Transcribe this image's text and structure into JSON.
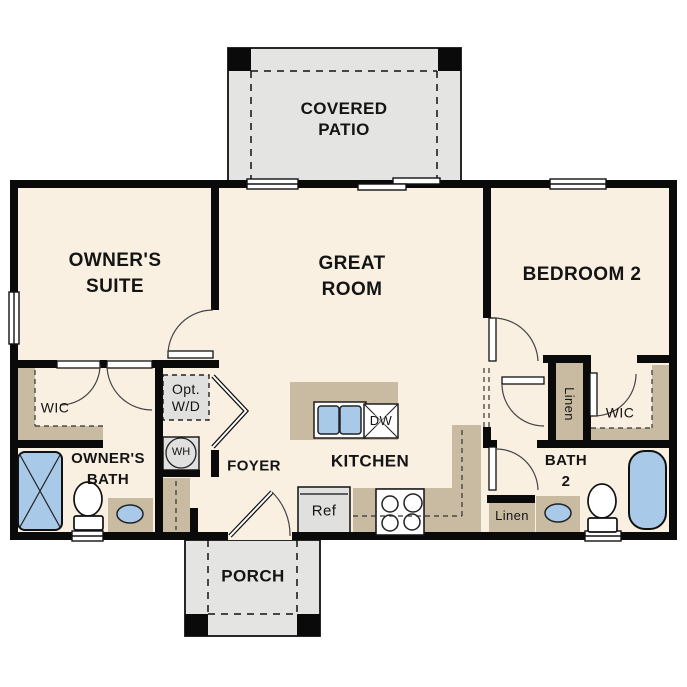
{
  "floorplan": {
    "rooms": {
      "covered_patio": {
        "line1": "COVERED",
        "line2": "PATIO"
      },
      "owners_suite": {
        "line1": "OWNER'S",
        "line2": "SUITE"
      },
      "great_room": {
        "line1": "GREAT",
        "line2": "ROOM"
      },
      "bedroom_2": {
        "label": "BEDROOM 2"
      },
      "owners_wic": {
        "label": "WIC"
      },
      "owners_bath": {
        "line1": "OWNER'S",
        "line2": "BATH"
      },
      "foyer": {
        "label": "FOYER"
      },
      "kitchen": {
        "label": "KITCHEN"
      },
      "bath_2": {
        "line1": "BATH",
        "line2": "2"
      },
      "bedroom2_wic": {
        "label": "WIC"
      },
      "hall_linen": {
        "label": "Linen"
      },
      "bath_linen": {
        "label": "Linen"
      },
      "porch": {
        "label": "PORCH"
      }
    },
    "fixtures": {
      "optional_washer_dryer": {
        "line1": "Opt.",
        "line2": "W/D"
      },
      "water_heater": {
        "label": "WH"
      },
      "refrigerator": {
        "label": "Ref"
      },
      "dishwasher": {
        "label": "DW"
      }
    },
    "colors": {
      "floor": "#f9f0e2",
      "patio_concrete": "#e4e4e2",
      "cabinetry_tan": "#c9bba2",
      "fixture_blue": "#a9c9e9",
      "appliance_gray": "#e0e0de",
      "wall_black": "#0a0a0a"
    }
  }
}
